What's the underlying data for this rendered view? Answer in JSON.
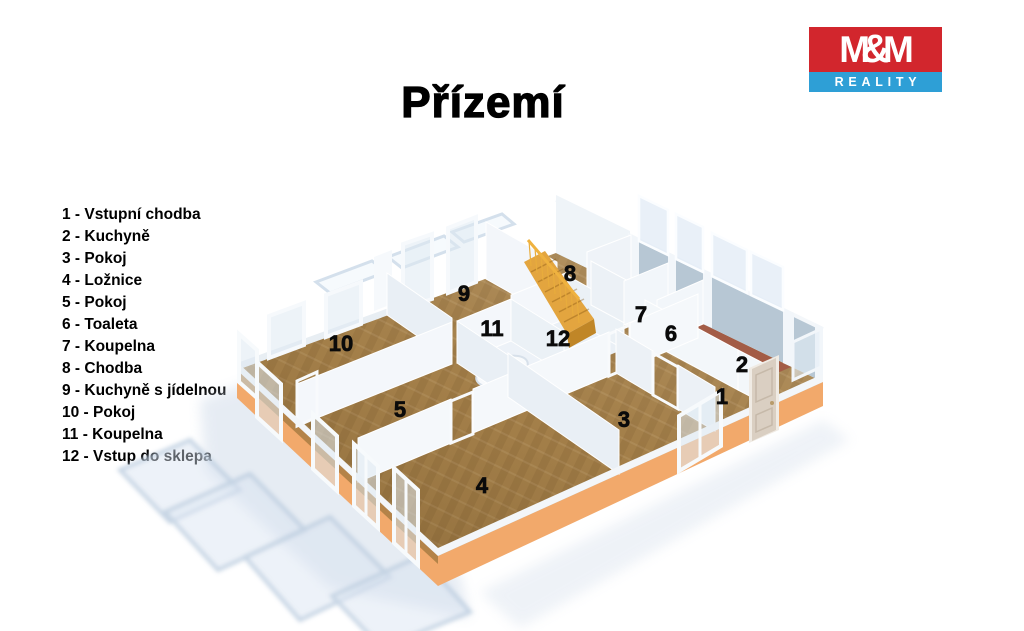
{
  "title": "Přízemí",
  "logo": {
    "top_text_left": "M",
    "top_text_amp": "&",
    "top_text_right": "M",
    "bottom_text": "REALITY",
    "colors": {
      "red": "#D2262D",
      "blue": "#2E9FD6",
      "text": "#FFFFFF"
    }
  },
  "legend": {
    "items": [
      "1 - Vstupní chodba",
      "2 - Kuchyně",
      "3 - Pokoj",
      "4 - Ložnice",
      "5 - Pokoj",
      "6 - Toaleta",
      "7 - Koupelna",
      "8 - Chodba",
      "9 - Kuchyně s jídelnou",
      "10 - Pokoj",
      "11 - Koupelna",
      "12 - Vstup do sklepa"
    ]
  },
  "floorplan": {
    "room_labels": [
      "1",
      "2",
      "3",
      "4",
      "5",
      "6",
      "7",
      "8",
      "9",
      "10",
      "11",
      "12"
    ],
    "colors": {
      "wood_floor": "#A8834C",
      "wood_streak": "#8F7038",
      "tile_floor": "#A35C46",
      "plinth": "#F2A96B",
      "plinth_dark": "#A97C42",
      "stairs": "#E3A53F",
      "stairs_side": "#C08627",
      "wall_white": "#F4F7FB",
      "wall_back_blue": "#B7C7D4",
      "shadow_blue": "#C9D6E6",
      "door": "#DACFC2",
      "bath_floor": "#EDF2F8"
    }
  }
}
